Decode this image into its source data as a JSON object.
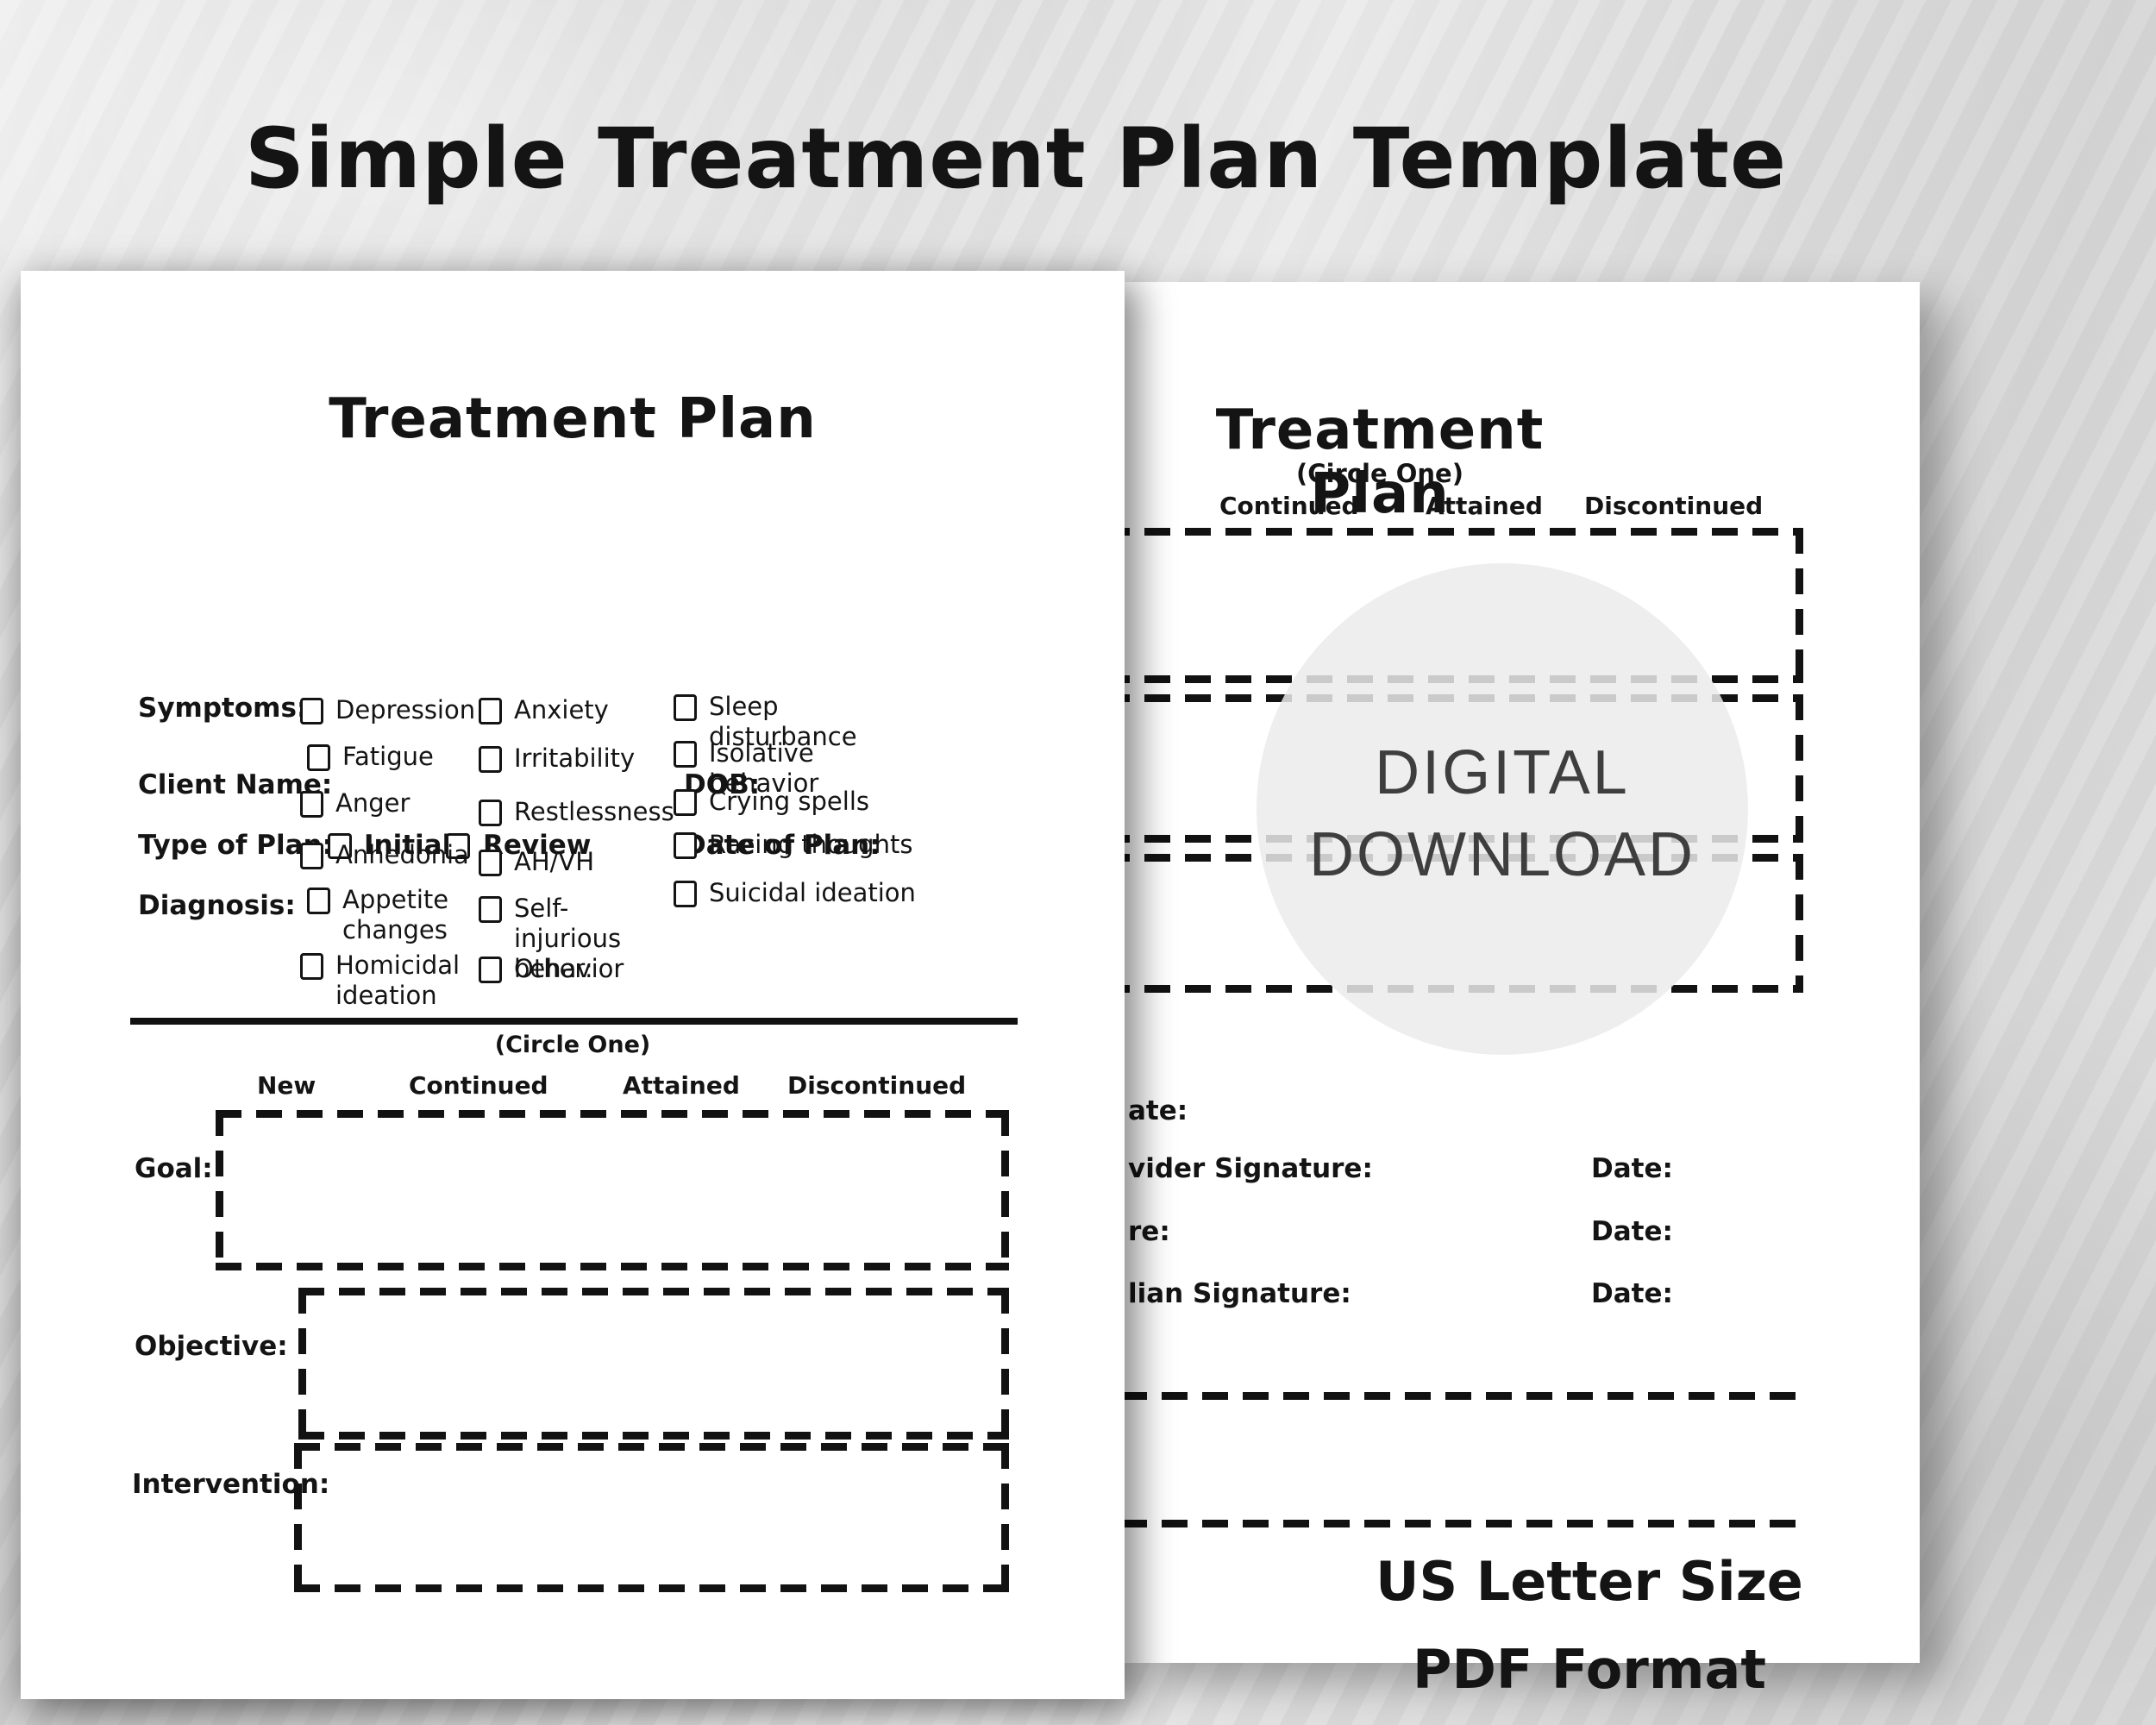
{
  "title": "Simple Treatment Plan Template",
  "front_page": {
    "heading": "Treatment Plan",
    "labels": {
      "client_name": "Client Name:",
      "dob": "DOB:",
      "type_of_plan": "Type of Plan:",
      "date_of_plan": "Date of Plan:",
      "diagnosis": "Diagnosis:",
      "symptoms": "Symptoms:",
      "goal": "Goal:",
      "objective": "Objective:",
      "intervention": "Intervention:"
    },
    "plan_type_options": [
      "Initial",
      "Review"
    ],
    "symptom_columns": {
      "col1": [
        "Depression",
        "Fatigue",
        "Anger",
        "Anhedonia",
        "Appetite changes",
        "Homicidal ideation"
      ],
      "col2": [
        "Anxiety",
        "Irritability",
        "Restlessness",
        "AH/VH",
        "Self-injurious behavior",
        "Other:"
      ],
      "col3": [
        "Sleep disturbance",
        "Isolative behavior",
        "Crying spells",
        "Racing thoughts",
        "Suicidal ideation"
      ]
    },
    "circle_one": "(Circle One)",
    "statuses": [
      "New",
      "Continued",
      "Attained",
      "Discontinued"
    ]
  },
  "back_page": {
    "heading": "Treatment Plan",
    "circle_one": "(Circle One)",
    "statuses": [
      "Continued",
      "Attained",
      "Discontinued"
    ],
    "signature_fragments": [
      "ate:",
      "vider Signature:",
      "re:",
      "lian Signature:"
    ],
    "date_label": "Date:",
    "watermark": [
      "DIGITAL",
      "DOWNLOAD"
    ],
    "footer": [
      "US Letter Size",
      "PDF Format"
    ]
  },
  "colors": {
    "background": "#dedede",
    "paper": "#ffffff",
    "ink": "#141414",
    "watermark_text": "#3e3e3e",
    "watermark_circle": "#ebebeb"
  }
}
